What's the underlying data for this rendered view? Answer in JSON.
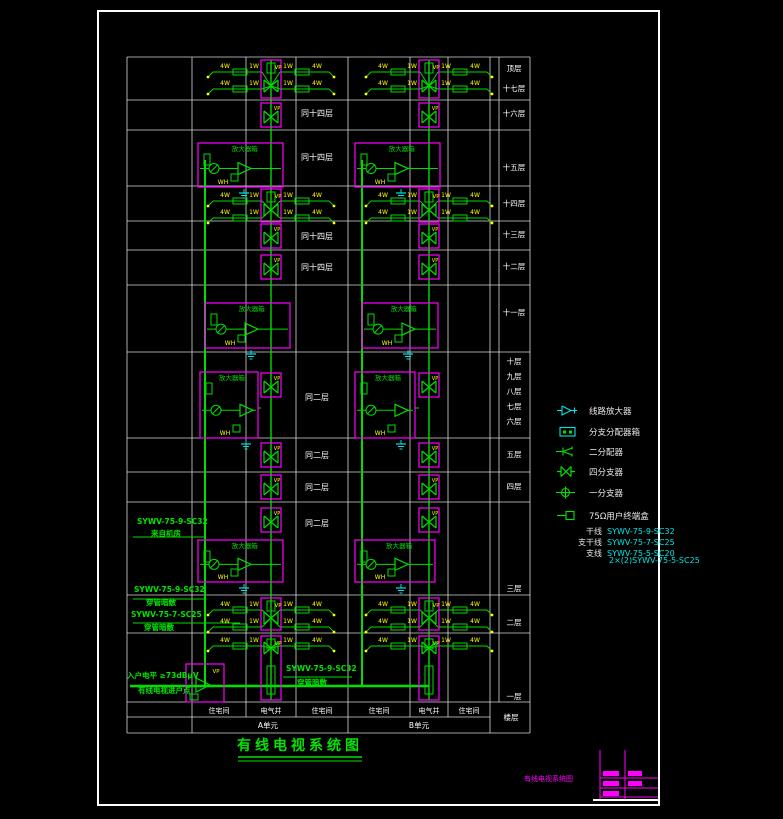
{
  "colors": {
    "grid": "#d9d9d9",
    "line": "#00dd00",
    "box": "#ff00ff",
    "tag": "#ffff00",
    "aux": "#00e5e5",
    "text": "#ffffff"
  },
  "title": {
    "text": "有线电视系统图"
  },
  "grid": {
    "floors_header": "楼层",
    "unit_a": "A单元",
    "unit_b": "B单元",
    "rooms": [
      "住宅间",
      "电气井",
      "住宅间"
    ],
    "floors": [
      "顶层",
      "十七层",
      "十六层",
      "十五层",
      "十四层",
      "十三层",
      "十二层",
      "十一层",
      "十层",
      "九层",
      "八层",
      "七层",
      "六层",
      "五层",
      "四层",
      "三层",
      "二层",
      "一层"
    ],
    "rows": [
      {
        "floors": [
          "顶层",
          "十七层"
        ],
        "type": "taps"
      },
      {
        "floors": [
          "十六层"
        ],
        "type": "same",
        "note": "同十四层"
      },
      {
        "floors": [
          "十五层"
        ],
        "type": "amp",
        "note": "同十四层"
      },
      {
        "floors": [
          "十四层"
        ],
        "type": "taps"
      },
      {
        "floors": [
          "十三层"
        ],
        "type": "same",
        "note": "同十四层"
      },
      {
        "floors": [
          "十二层"
        ],
        "type": "same",
        "note": "同十四层"
      },
      {
        "floors": [
          "十一层"
        ],
        "type": "amp"
      },
      {
        "floors": [
          "十层",
          "九层",
          "八层",
          "七层",
          "六层"
        ],
        "type": "amp",
        "note": "同二层"
      },
      {
        "floors": [
          "五层"
        ],
        "type": "same",
        "note": "同二层"
      },
      {
        "floors": [
          "四层"
        ],
        "type": "same",
        "note": "同二层"
      },
      {
        "floors": [
          "三层"
        ],
        "type": "amp",
        "note": "同二层"
      },
      {
        "floors": [
          "二层"
        ],
        "type": "taps"
      },
      {
        "floors": [
          "一层"
        ],
        "type": "entry"
      }
    ]
  },
  "components": {
    "amp_box_label": "放大器箱",
    "wh": "WH",
    "vp": "VP",
    "tap_outer": "4W",
    "tap_inner": "1W"
  },
  "feeders": [
    {
      "spec": "SYWV-75-9-SC32",
      "sub": "来自机房"
    },
    {
      "spec": "SYWV-75-9-SC32",
      "sub": "穿管暗敷"
    },
    {
      "spec": "SYWV-75-7-SC25",
      "sub": "穿管暗敷"
    }
  ],
  "entry": {
    "level": "入户电平 ≥73dBμV",
    "point": "有线电视进户点",
    "riser_spec": "SYWV-75-9-SC32",
    "riser_sub": "穿管暗敷"
  },
  "legend": {
    "items": [
      {
        "icon": "line-amplifier",
        "label": "线路放大器"
      },
      {
        "icon": "junction-box",
        "label": "分支分配器箱"
      },
      {
        "icon": "splitter-2",
        "label": "二分配器"
      },
      {
        "icon": "tap-4",
        "label": "四分支器"
      },
      {
        "icon": "tap-1",
        "label": "一分支器"
      },
      {
        "icon": "outlet",
        "label": "75Ω用户终端盒"
      }
    ],
    "cables": [
      {
        "name": "干线",
        "spec": "SYWV-75-9-SC32"
      },
      {
        "name": "支干线",
        "spec": "SYWV-75-7-SC25"
      },
      {
        "name": "支线",
        "spec": "SYWV-75-5-SC20",
        "spec2": "2×(2)SYWV-75-5-SC25"
      }
    ]
  },
  "titleblock": {
    "caption": "有线电视系统图"
  }
}
